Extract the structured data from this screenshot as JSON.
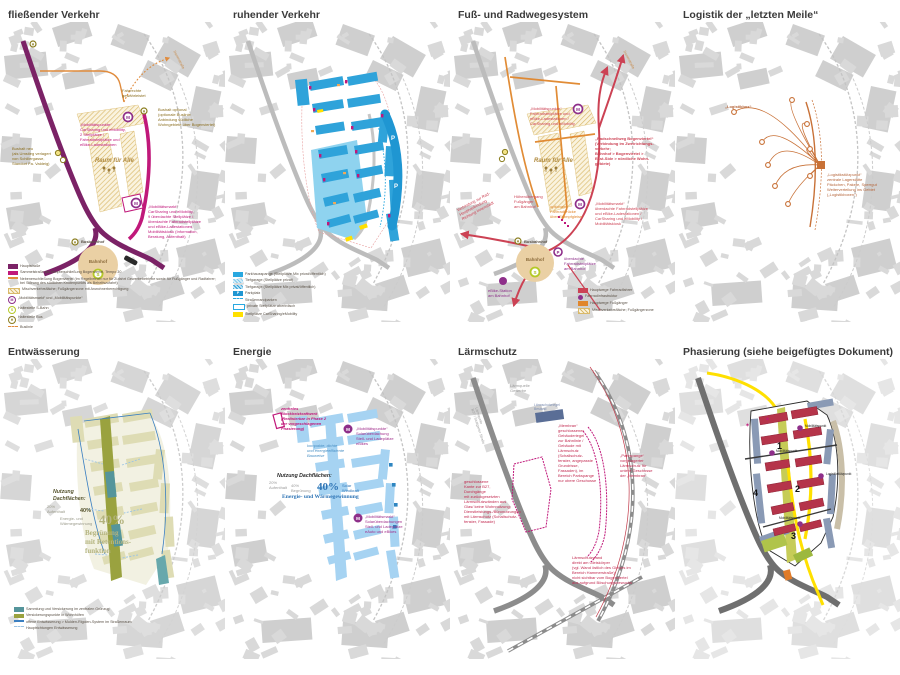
{
  "glyphs": {
    "m": "M",
    "s": "S",
    "h": "H",
    "p": "P"
  },
  "panels": [
    {
      "title": "fließender Verkehr",
      "annotations": {
        "mp": "„Mobilitätspunkte“\nCarSharing und eMobility,\n2 Stellplätze /\nFahrradstellplätze und\neBike-Ladestationen",
        "bushalt_optional": "Bushalt optional\n(optionale Buslinie\nAnbindung südliche\nWohngebiete über Bogenviertel)",
        "fahrrechte": "Fahrrechte\ngewährleistet",
        "bushalt_neu": "Bushalt neu\n(als Umstieg verlagert\nvon Schillergasse,\nStandort Fa. Valdeig)",
        "raum": "Raum für Alle",
        "mm": "„Mobilitätsmarkt“\nCarSharing und eMobility,\n9 überdachte Stellplätze /\nüberdachte Fahrradstellplätze\nund eBike-Ladestationen,\nMobilitätskiosk (Information,\nBeratung, Aufenthalt)",
        "busbahnhof": "Busbahnhof",
        "bahnhof": "Bahnhof",
        "dammstrasse": "Dammstraße"
      },
      "legend": [
        {
          "swatch": "rect",
          "color": "#7b2266",
          "label": "Hauptstraße"
        },
        {
          "swatch": "rect",
          "color": "#c0187a",
          "label": "Sammelstraße als Haupterschließung Bogenviertel, Tempo 30"
        },
        {
          "swatch": "line",
          "color": "#e08b3c",
          "label": "Nebenerschließung Bogenviertel (im Regelbetrieb nur für Zufahrt Gewerbebetriebe sowie für Fußgänger und Radfahrer; bei Störung des südlichen Knotenpunkts als Behelfszufahrt)"
        },
        {
          "swatch": "hatch",
          "label": "Mischverkehrsfläche; Fußgängerzone mit Anwohnerberechtigung"
        },
        {
          "swatch": "circle",
          "color": "#8e2f8a",
          "letter": "M",
          "label": "„Mobilitätsmarkt“ und „Mobilitätspunkte“"
        },
        {
          "swatch": "circle",
          "color": "#b5c927",
          "letter": "S",
          "label": "Haltestelle S-Bahn"
        },
        {
          "swatch": "circle",
          "color": "#8a7d1e",
          "letter": "H",
          "label": "Haltestelle Bus"
        },
        {
          "swatch": "dash",
          "color": "#e08b3c",
          "label": "Buslinie"
        }
      ]
    },
    {
      "title": "ruhender Verkehr",
      "legend": [
        {
          "swatch": "rect",
          "color": "#29a8e0",
          "label": "Parkhausspange (Stellplätze Mix privat/öffentlich)"
        },
        {
          "swatch": "stripe",
          "label": "Tiefgarage (Stellplätze privat)"
        },
        {
          "swatch": "stripe2",
          "label": "Tiefgarage (Stellplätze Mix privat/öffentlich)"
        },
        {
          "swatch": "boxletter",
          "color": "#1f96d2",
          "letter": "P",
          "label": "Parkplatz"
        },
        {
          "swatch": "dash",
          "color": "#29a8e0",
          "label": "Straßenrandparken"
        },
        {
          "swatch": "border",
          "color": "#29a8e0",
          "label": "private Stellplätze oberirdisch"
        },
        {
          "swatch": "rect",
          "color": "#ffe000",
          "label": "Stellplätze CarSharing/eMobility"
        }
      ]
    },
    {
      "title": "Fuß- und Radwegesystem",
      "annotations": {
        "mp": "„Mobilitätspunkte“\nFahrradstellplätze und\neBike-Ladestationen /\nCarSharing und eMobility",
        "radschnellweg": "„Radschnellweg Bogenviertel“\n(Verbindung im Zweirichtungs-\nverkehr;\nBahnhof > Bogenviertel >\nEast-Side > nördliche Wohn-\ngebiete)",
        "mm": "„Mobilitätsmarkt“\nüberdachte Fahrradstellplätze\nund eBike-Ladestationen /\nCarSharing und eMobility /\nMobilitätskiosk",
        "verbindung": "Verbindung zur Rad-\nHauptverbindung\nRichtung Innenstadt",
        "hoehen": "Höhenübergang\nFußgänger\nam Bahnhof",
        "bruecke": "optionale\nFahrradbrücke\nüber Stumpfgleise",
        "busbahnhof": "Busbahnhof",
        "bahnhof": "Bahnhof",
        "ebike": "eBike-Station\nam Bahnhof",
        "fahrradstell": "überdachte\nFahrradstellplätze\nam Bahnhof",
        "raum": "Raum für Alle",
        "dammstrasse": "Dammstraße"
      },
      "legend": [
        {
          "swatch": "rect",
          "color": "#cc4254",
          "label": "Hauptwege Fahrradfahrer"
        },
        {
          "swatch": "dot",
          "color": "#8e2f8a",
          "label": "Fahrradinfrastruktur"
        },
        {
          "swatch": "rect",
          "color": "#e0862c",
          "label": "Hauptwege Fußgänger"
        },
        {
          "swatch": "hatch",
          "label": "Mischverkehrsfläche; Fußgängerzone"
        }
      ]
    },
    {
      "title": "Logistik der „letzten Meile“",
      "annotations": {
        "logistikbox": "„Logistikbox“",
        "stuetzpunkt": "„Logistikstützpunkt“\nzentrale Lagerstätte\nPäckchen, Pakete, Sperrgut\nWeiterverteilung ins Gebiet\n(„Logistikboxen“)"
      }
    },
    {
      "title": "Entwässerung",
      "text": {
        "nutzung_header": "Nutzung\nDachflächen:",
        "p20": "20%\nAufenthalt",
        "p40_small": "40%",
        "p40_small_label": "Energie- und\nWärmegewinnung",
        "p40_big": "40%",
        "p40_big_label": "Begrünung\nmit Retentions-\nfunktion"
      },
      "legend": [
        {
          "swatch": "rect",
          "color": "#55959b",
          "label": "Sammlung und Versickerung im zentralen Grünzug"
        },
        {
          "swatch": "rect",
          "color": "#9aa23f",
          "label": "Versickerungspunkte in Wohnhöfen"
        },
        {
          "swatch": "line",
          "color": "#3a7fc1",
          "label": "offene Entwässerung > Mulden-Rigolen-System im Straßenraum"
        },
        {
          "swatch": "dash",
          "color": "#9cc4e4",
          "label": "Hauptrichtungen Entwässerung"
        }
      ]
    },
    {
      "title": "Energie",
      "annotations": {
        "bhkw": "zentrales\nBlockheizkraftwerk\n(Realisierbar in Phase 2\nder vorgeschlagenen\nPhasierung)",
        "mp": "„Mobilitätspunkte“\nSolarüberdachung\nStell- und Ladeplätze\neBikes",
        "kompakt": "kompakte, dichte\nund energieeffiziente\nBauweise",
        "mm": "„Mobilitätsmarkt“\nSolarüberdachungen\nStell- und Ladeplätze\neAuto und eBikes"
      },
      "text": {
        "nutzung_header": "Nutzung Dachflächen:",
        "p20": "20%\nAufenthalt",
        "p40a": "40%\nBegrünung",
        "p40_big": "40%",
        "p40_big_label": "Solar\nWindkraft",
        "energie_line": "Energie- und Wärmegewinnung"
      }
    },
    {
      "title": "Lärmschutz",
      "annotations": {
        "q_gewerbe": "Lärmquelle\nGewerbe",
        "q_b27": "Lärmquelle\nB27 / Stuttgarter Straße",
        "q_bahn": "Lärmquelle Bahn",
        "riegel": "Lärmschutzriegel\nBestand",
        "membran": "„Membran“\ngeschlossener\nGebäuderiegel\nzur Bahnlinie /\nGebäude mit\nLärmschutz\n(Schallschutz-\nfenster, angepasste\nGrundrisse,\nFassaden), im\nBereich Parkspange\nnur obere Geschosse",
        "parkspange": "„Parkspange“\nvorgelagerter\nLärmschutz für\nuntere Geschosse\nder „Membran“",
        "kante": "geschlossene\nKante zur B27,\nDurchgänge\nmit zurückgesetzten\nLärmschutzwänden aus\nGlas/ keine Wohnnutzung;\nDienstleistungs-/Büronutzungen\nmit Lärmschutz (Schallschutz-\nfenster, Fassade)",
        "wand": "Lärmschutzwand\ndirekt am Gleiskörper\n(vgl. Wand östlich des Gleises im\nBereich Hammerstraße);\nnicht sichtbar vom Bogenviertel\naus aufgrund Böschungsbewuchs"
      }
    },
    {
      "title": "Phasierung (siehe beigefügtes Dokument)",
      "phases": [
        "1",
        "2",
        "3",
        "4"
      ],
      "poi": [
        "Mobilitätspunkt",
        "Mobilitätspunkt",
        "Logistikstützpunkt",
        "Mobilitätsmarkt"
      ]
    }
  ]
}
